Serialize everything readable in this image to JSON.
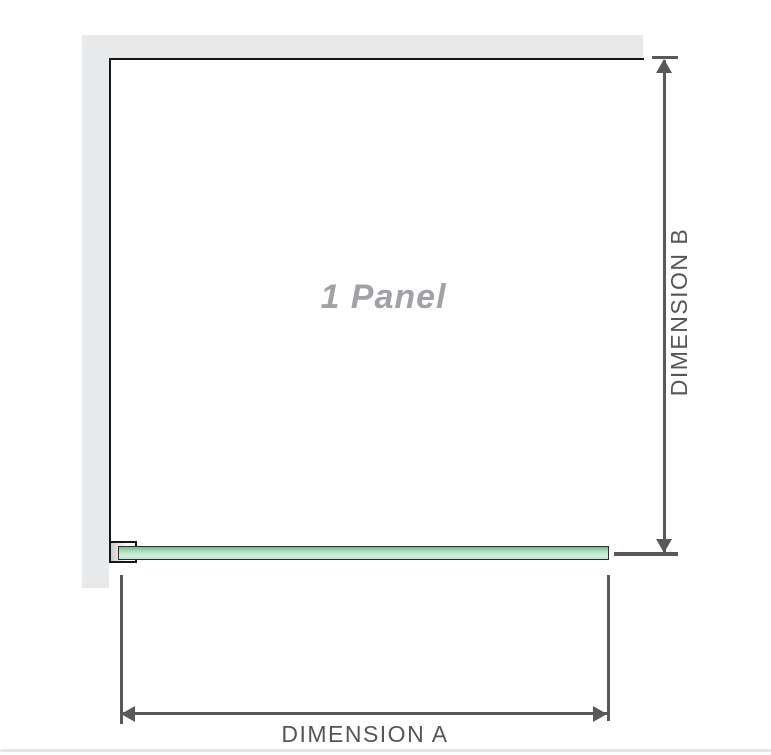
{
  "diagram": {
    "panel_label": "1 Panel",
    "dimension_a": {
      "label": "DIMENSION A"
    },
    "dimension_b": {
      "label": "DIMENSION B"
    }
  },
  "colors": {
    "wall_gray": "#e8e9ea",
    "outline_black": "#161616",
    "dimension_line_gray": "#58595b",
    "dimension_label_gray": "#55565a",
    "panel_label_gray": "#a0a2a5",
    "glass_green_dark": "#7fc093",
    "glass_green_mid": "#a9dcb9",
    "glass_green_light": "#d5efe0",
    "bottom_divider_gray": "#e6e5e3"
  }
}
